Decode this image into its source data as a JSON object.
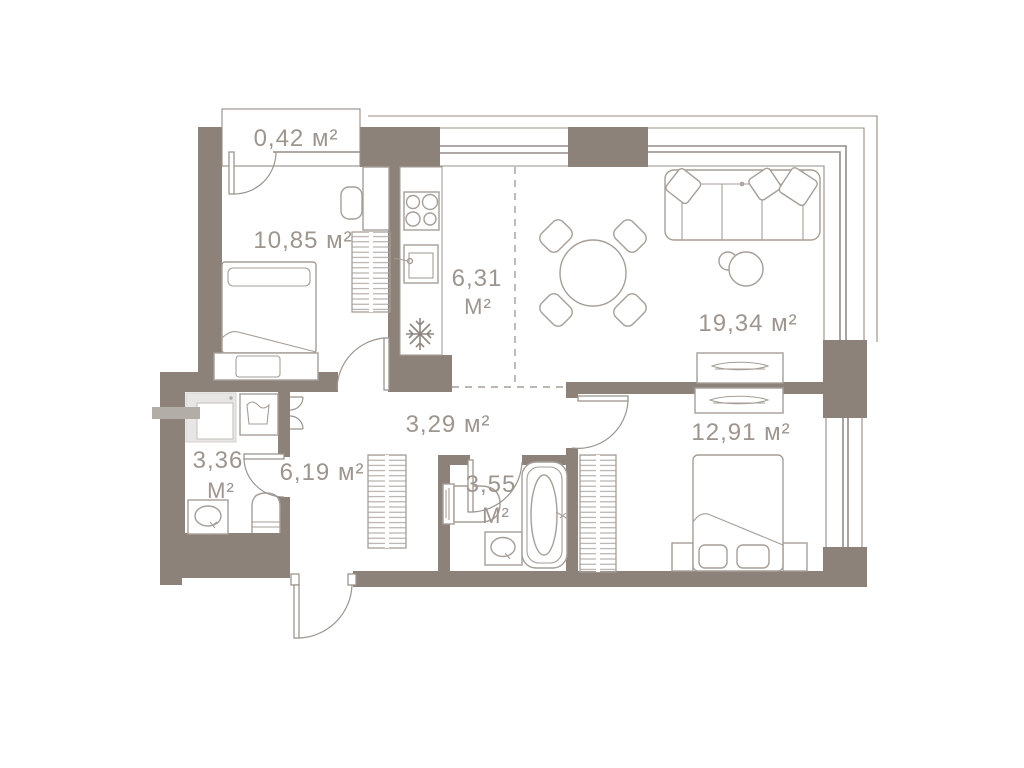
{
  "plan": {
    "title": "apartment floor plan",
    "palette": {
      "wall": "#8c8279",
      "line": "#a69e97",
      "door": "#9c948d",
      "win": "#958c85",
      "text": "#9d958e"
    },
    "rooms": [
      {
        "id": "balcony",
        "area": "0,42 м²"
      },
      {
        "id": "bedroom-1",
        "area": "10,85 м²"
      },
      {
        "id": "kitchen",
        "area": "6,31",
        "unit": "М²"
      },
      {
        "id": "living-room",
        "area": "19,34 м²"
      },
      {
        "id": "hallway",
        "area": "3,29 м²"
      },
      {
        "id": "bedroom-2",
        "area": "12,91 м²"
      },
      {
        "id": "bathroom-1",
        "area": "3,36",
        "unit": "М²"
      },
      {
        "id": "entry-hall",
        "area": "6,19 м²"
      },
      {
        "id": "bathroom-2",
        "area": "3,55",
        "unit": "М²"
      }
    ],
    "icons": {
      "refrigerator": "snowflake-icon",
      "stove": "burners-icon",
      "bath": "bathtub-icon"
    }
  }
}
